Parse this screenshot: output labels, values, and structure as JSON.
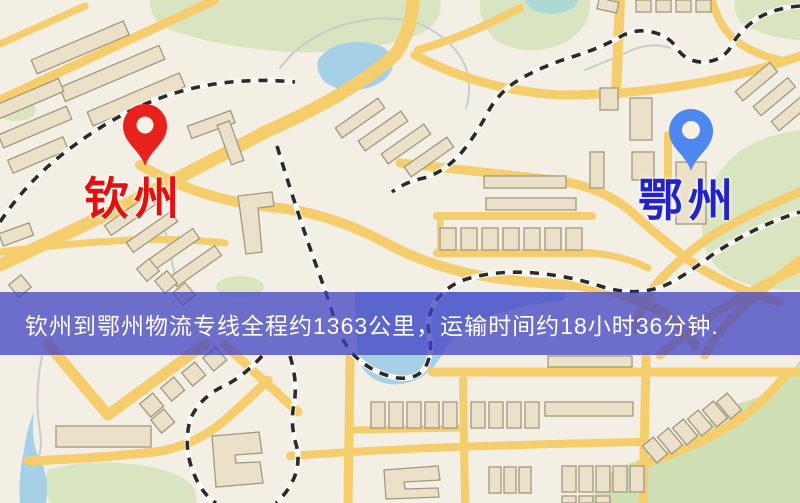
{
  "banner": {
    "text": "钦州到鄂州物流专线全程约1363公里，运输时间约18小时36分钟.",
    "background": "rgba(64,66,196,0.75)",
    "css": "background:rgba(64,66,196,0.75)",
    "text_color": "#ffffff"
  },
  "map": {
    "markers": [
      {
        "id": "qinzhou",
        "label": "钦州",
        "pin_color": "#e8211d",
        "pin_hole_color": "#f6f1e5",
        "label_color": "#e60e0e",
        "label_style": "color:#e60e0e"
      },
      {
        "id": "ezhou",
        "label": "鄂州",
        "pin_color": "#4f87f0",
        "pin_hole_color": "#f6f1e5",
        "label_color": "#2121cf",
        "label_style": "color:#2121cf"
      }
    ],
    "palette": {
      "background": "#f3efe4",
      "road": "#f6cd6d",
      "building_fill": "#eae1c8",
      "building_stroke": "#a3987d",
      "park": "#d8e5c0",
      "water": "#a6d0e6",
      "railway": "#2a2a2a"
    }
  }
}
